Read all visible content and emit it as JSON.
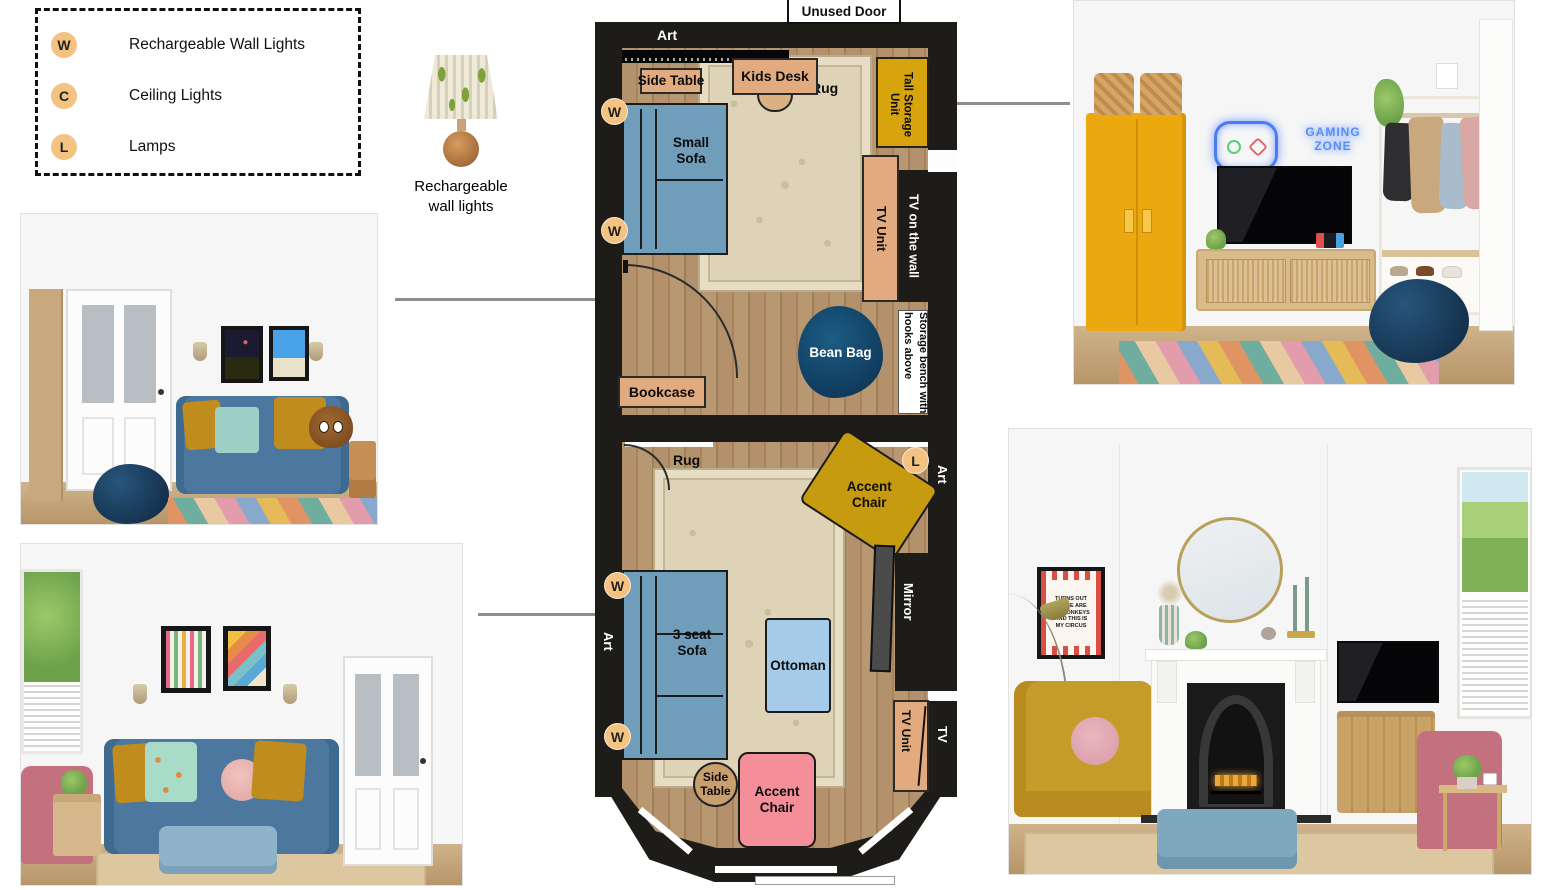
{
  "legend": {
    "items": [
      {
        "symbol": "W",
        "label": "Rechargeable Wall Lights"
      },
      {
        "symbol": "C",
        "label": "Ceiling Lights"
      },
      {
        "symbol": "L",
        "label": "Lamps"
      }
    ]
  },
  "wall_light_figure": {
    "caption": "Rechargeable wall lights"
  },
  "floor_plan": {
    "unused_door": "Unused Door",
    "upper_room": {
      "art": "Art",
      "side_table": "Side Table",
      "kids_desk": "Kids Desk",
      "rug": "Rug",
      "tall_storage_unit": "Tall Storage Unit",
      "small_sofa": "Small Sofa",
      "tv_unit": "TV Unit",
      "tv_on_the_wall": "TV on the wall",
      "bean_bag": "Bean Bag",
      "storage_bench": "Storage bench with hooks above",
      "bookcase": "Bookcase"
    },
    "lower_room": {
      "rug": "Rug",
      "accent_chair_gold": "Accent Chair",
      "art_right": "Art",
      "mirror": "Mirror",
      "three_seat_sofa": "3 seat Sofa",
      "ottoman": "Ottoman",
      "art_left": "Art",
      "tv_unit": "TV Unit",
      "tv": "TV",
      "side_table": "Side Table",
      "accent_chair_pink": "Accent Chair"
    },
    "markers": {
      "wall_light": "W",
      "lamp": "L"
    }
  },
  "renders": {
    "top_right": {
      "neon_sign": "GAMING ZONE"
    },
    "bottom_right": {
      "poster_text": "TURNS OUT THESE ARE MY MONKEYS AND THIS IS MY CIRCUS"
    }
  },
  "colors": {
    "marker_orange": "#f4c382",
    "wall_black": "#1e1c19",
    "floor_wood": "#b3916c",
    "rug_beige": "#ded3b6",
    "sofa_blue": "#6f9dba",
    "ottoman_blue": "#a6cbe9",
    "storage_gold": "#d8a40e",
    "accent_chair_gold": "#c79b10",
    "accent_chair_pink": "#f48f99",
    "furniture_tan": "#e2ab7f",
    "bean_bag_navy": "#15486e",
    "connector_gray": "#8e8e8e",
    "locker_yellow": "#eca80f",
    "neon_blue": "#4a7cf0"
  }
}
